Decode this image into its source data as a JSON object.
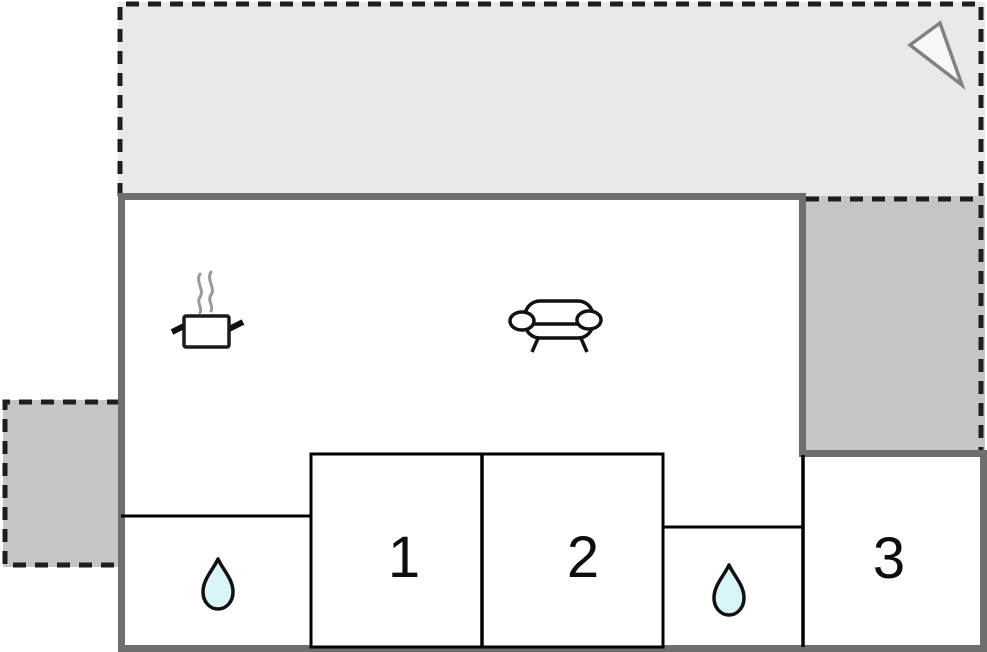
{
  "floor_plan": {
    "rooms": [
      {
        "id": "room-1",
        "label": "1"
      },
      {
        "id": "room-2",
        "label": "2"
      },
      {
        "id": "room-3",
        "label": "3"
      }
    ],
    "icons": [
      {
        "name": "cooking-pot-icon",
        "located_in": "main-room-left"
      },
      {
        "name": "steam-icon",
        "located_in": "main-room-left"
      },
      {
        "name": "sofa-icon",
        "located_in": "main-room-center"
      },
      {
        "name": "water-drop-icon",
        "located_in": "bathroom-left"
      },
      {
        "name": "water-drop-icon",
        "located_in": "bathroom-middle"
      },
      {
        "name": "north-arrow-icon",
        "located_in": "terrace-top"
      }
    ],
    "colors": {
      "terrace_light_fill": "#e9e9e9",
      "terrace_dark_fill": "#c5c5c5",
      "wall": "#6e6e6e",
      "partition": "#000000",
      "dashed_outline": "#1e1e1e",
      "room_fill": "#ffffff",
      "water_drop_fill": "#d8f5f8",
      "north_arrow_fill": "#f7f7f7",
      "north_arrow_stroke": "#828282",
      "steam_stroke": "#9a9a9a"
    }
  }
}
